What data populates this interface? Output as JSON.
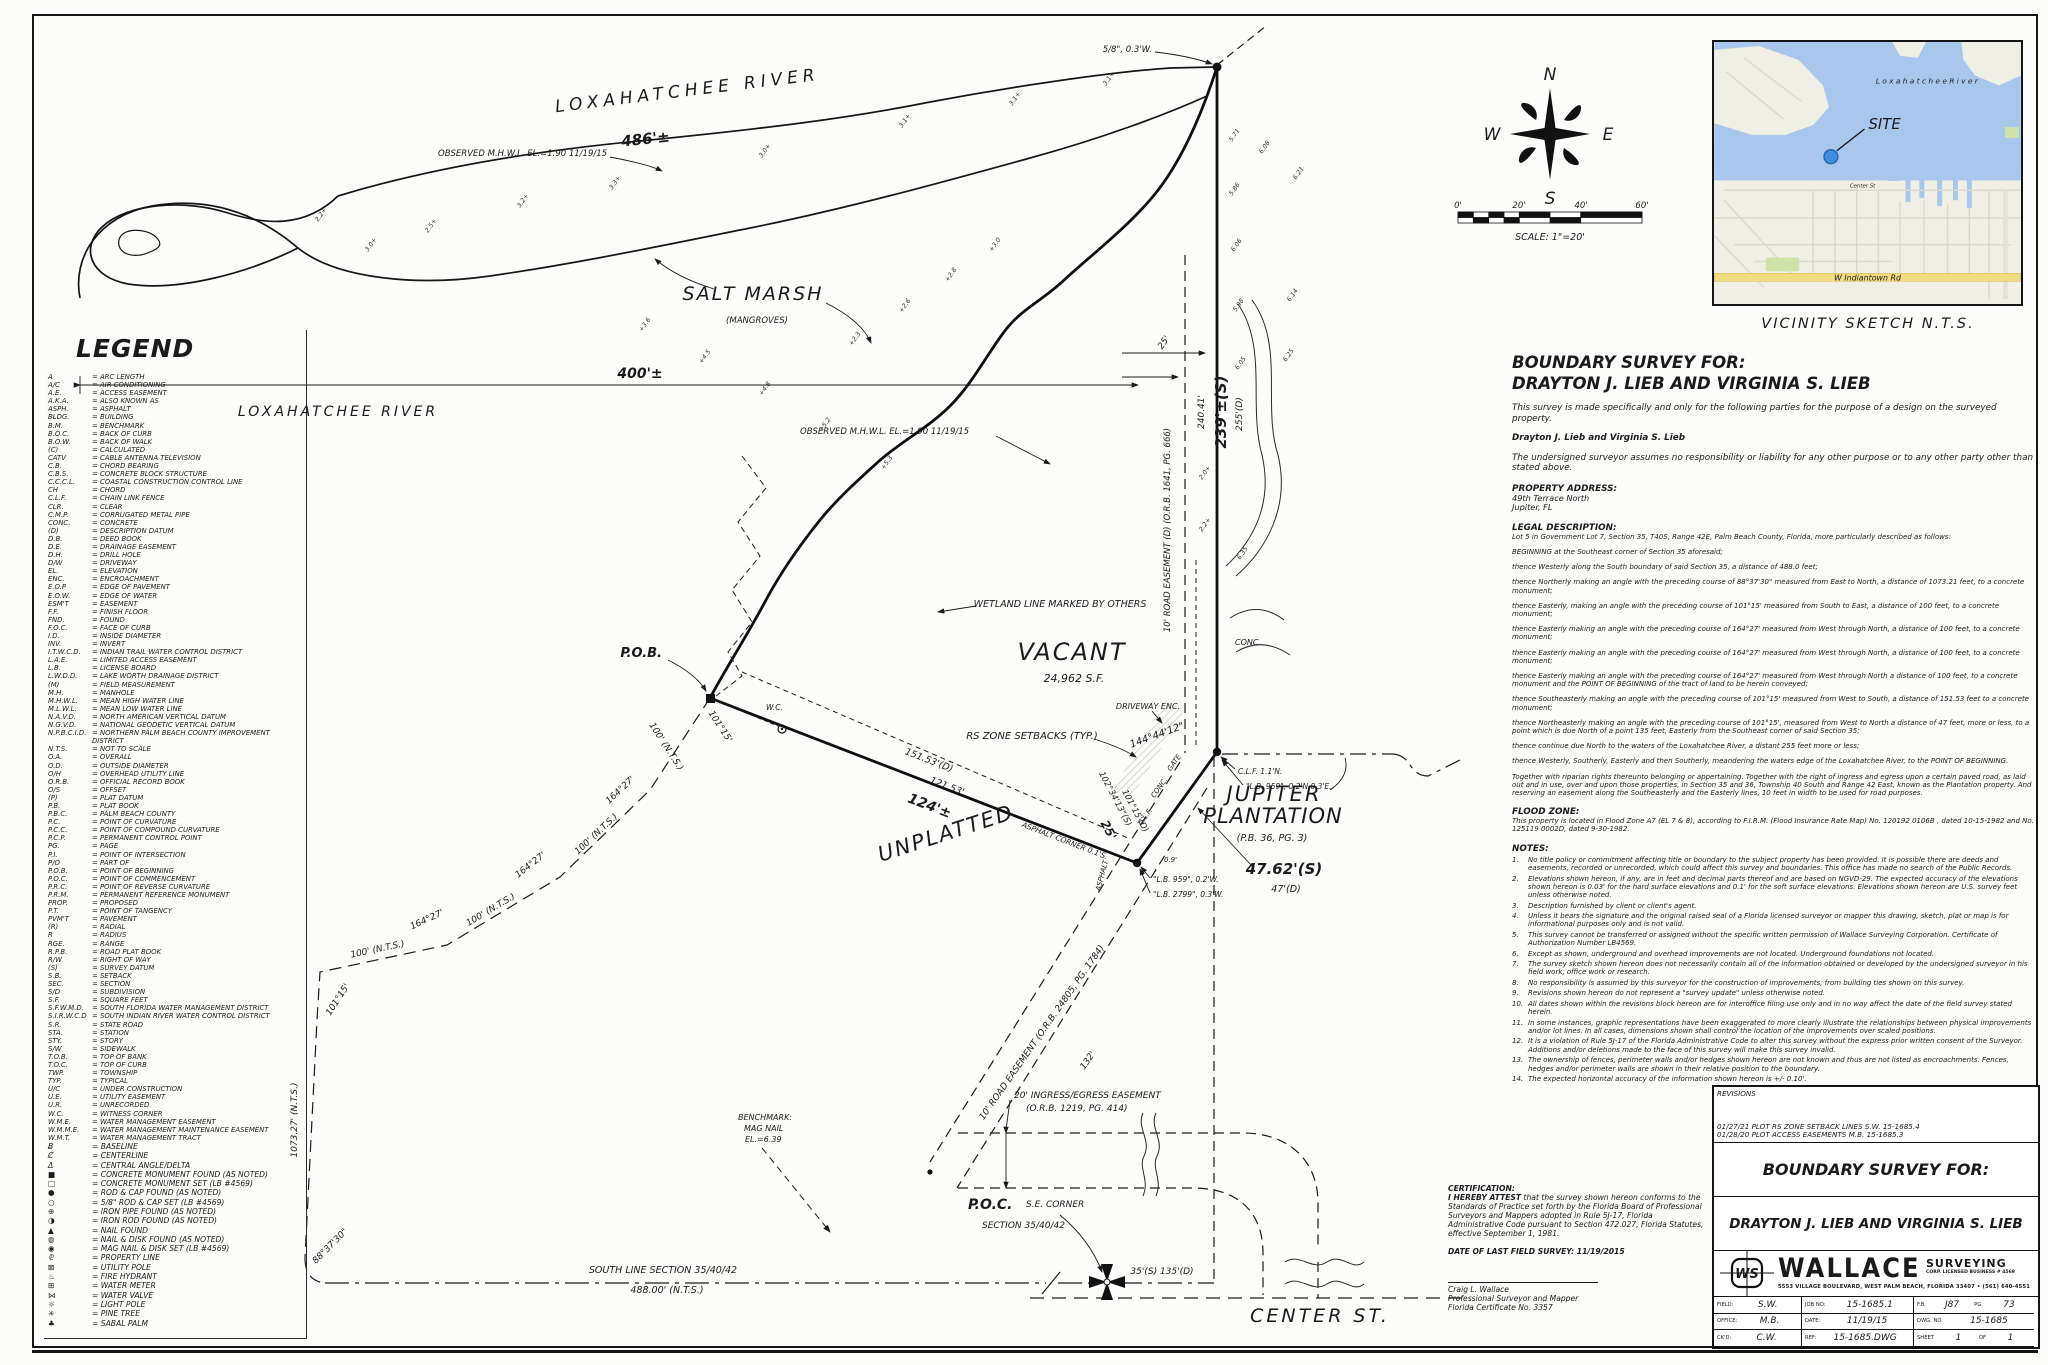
{
  "legend": {
    "title": "LEGEND",
    "entries": [
      {
        "a": "A",
        "m": "ARC LENGTH"
      },
      {
        "a": "A/C",
        "m": "AIR CONDITIONING"
      },
      {
        "a": "A.E.",
        "m": "ACCESS EASEMENT"
      },
      {
        "a": "A.K.A.",
        "m": "ALSO KNOWN AS"
      },
      {
        "a": "ASPH.",
        "m": "ASPHALT"
      },
      {
        "a": "BLDG.",
        "m": "BUILDING"
      },
      {
        "a": "B.M.",
        "m": "BENCHMARK"
      },
      {
        "a": "B.O.C.",
        "m": "BACK OF CURB"
      },
      {
        "a": "B.O.W.",
        "m": "BACK OF WALK"
      },
      {
        "a": "(C)",
        "m": "CALCULATED"
      },
      {
        "a": "CATV",
        "m": "CABLE ANTENNA TELEVISION"
      },
      {
        "a": "C.B.",
        "m": "CHORD BEARING"
      },
      {
        "a": "C.B.S.",
        "m": "CONCRETE BLOCK STRUCTURE"
      },
      {
        "a": "C.C.C.L.",
        "m": "COASTAL CONSTRUCTION CONTROL LINE"
      },
      {
        "a": "CH",
        "m": "CHORD"
      },
      {
        "a": "C.L.F.",
        "m": "CHAIN LINK FENCE"
      },
      {
        "a": "CLR.",
        "m": "CLEAR"
      },
      {
        "a": "C.M.P.",
        "m": "CORRUGATED METAL PIPE"
      },
      {
        "a": "CONC.",
        "m": "CONCRETE"
      },
      {
        "a": "(D)",
        "m": "DESCRIPTION DATUM"
      },
      {
        "a": "D.B.",
        "m": "DEED BOOK"
      },
      {
        "a": "D.E.",
        "m": "DRAINAGE EASEMENT"
      },
      {
        "a": "D.H.",
        "m": "DRILL HOLE"
      },
      {
        "a": "D/W",
        "m": "DRIVEWAY"
      },
      {
        "a": "EL.",
        "m": "ELEVATION"
      },
      {
        "a": "ENC.",
        "m": "ENCROACHMENT"
      },
      {
        "a": "E.O.P",
        "m": "EDGE OF PAVEMENT"
      },
      {
        "a": "E.O.W.",
        "m": "EDGE OF WATER"
      },
      {
        "a": "ESM'T",
        "m": "EASEMENT"
      },
      {
        "a": "F.F.",
        "m": "FINISH FLOOR"
      },
      {
        "a": "FND.",
        "m": "FOUND"
      },
      {
        "a": "F.O.C.",
        "m": "FACE OF CURB"
      },
      {
        "a": "I.D.",
        "m": "INSIDE DIAMETER"
      },
      {
        "a": "INV.",
        "m": "INVERT"
      },
      {
        "a": "I.T.W.C.D.",
        "m": "INDIAN TRAIL WATER CONTROL DISTRICT"
      },
      {
        "a": "L.A.E.",
        "m": "LIMITED ACCESS EASEMENT"
      },
      {
        "a": "L.B.",
        "m": "LICENSE BOARD"
      },
      {
        "a": "L.W.D.D.",
        "m": "LAKE WORTH DRAINAGE DISTRICT"
      },
      {
        "a": "(M)",
        "m": "FIELD MEASUREMENT"
      },
      {
        "a": "M.H.",
        "m": "MANHOLE"
      },
      {
        "a": "M.H.W.L.",
        "m": "MEAN HIGH WATER LINE"
      },
      {
        "a": "M.L.W.L.",
        "m": "MEAN LOW WATER LINE"
      },
      {
        "a": "N.A.V.D.",
        "m": "NORTH AMERICAN VERTICAL DATUM"
      },
      {
        "a": "N.G.V.D.",
        "m": "NATIONAL GEODETIC VERTICAL DATUM"
      },
      {
        "a": "N.P.B.C.I.D.",
        "m": "NORTHERN PALM BEACH COUNTY IMPROVEMENT DISTRICT"
      },
      {
        "a": "N.T.S.",
        "m": "NOT TO SCALE"
      },
      {
        "a": "O.A.",
        "m": "OVERALL"
      },
      {
        "a": "O.D.",
        "m": "OUTSIDE DIAMETER"
      },
      {
        "a": "O/H",
        "m": "OVERHEAD UTILITY LINE"
      },
      {
        "a": "O.R.B.",
        "m": "OFFICIAL RECORD BOOK"
      },
      {
        "a": "O/S",
        "m": "OFFSET"
      },
      {
        "a": "(P)",
        "m": "PLAT DATUM"
      },
      {
        "a": "P.B.",
        "m": "PLAT BOOK"
      },
      {
        "a": "P.B.C.",
        "m": "PALM BEACH COUNTY"
      },
      {
        "a": "P.C.",
        "m": "POINT OF CURVATURE"
      },
      {
        "a": "P.C.C.",
        "m": "POINT OF COMPOUND CURVATURE"
      },
      {
        "a": "P.C.P.",
        "m": "PERMANENT CONTROL POINT"
      },
      {
        "a": "PG.",
        "m": "PAGE"
      },
      {
        "a": "P.I.",
        "m": "POINT OF INTERSECTION"
      },
      {
        "a": "P/O",
        "m": "PART OF"
      },
      {
        "a": "P.O.B.",
        "m": "POINT OF BEGINNING"
      },
      {
        "a": "P.O.C.",
        "m": "POINT OF COMMENCEMENT"
      },
      {
        "a": "P.R.C.",
        "m": "POINT OF REVERSE CURVATURE"
      },
      {
        "a": "P.R.M.",
        "m": "PERMANENT REFERENCE MONUMENT"
      },
      {
        "a": "PROP.",
        "m": "PROPOSED"
      },
      {
        "a": "P.T.",
        "m": "POINT OF TANGENCY"
      },
      {
        "a": "PVM'T",
        "m": "PAVEMENT"
      },
      {
        "a": "(R)",
        "m": "RADIAL"
      },
      {
        "a": "R",
        "m": "RADIUS"
      },
      {
        "a": "RGE.",
        "m": "RANGE"
      },
      {
        "a": "R.P.B.",
        "m": "ROAD PLAT BOOK"
      },
      {
        "a": "R/W",
        "m": "RIGHT OF WAY"
      },
      {
        "a": "(S)",
        "m": "SURVEY DATUM"
      },
      {
        "a": "S.B.",
        "m": "SETBACK"
      },
      {
        "a": "SEC.",
        "m": "SECTION"
      },
      {
        "a": "S/D",
        "m": "SUBDIVISION"
      },
      {
        "a": "S.F.",
        "m": "SQUARE FEET"
      },
      {
        "a": "S.F.W.M.D.",
        "m": "SOUTH FLORIDA WATER MANAGEMENT DISTRICT"
      },
      {
        "a": "S.I.R.W.C.D",
        "m": "SOUTH INDIAN RIVER WATER CONTROL DISTRICT"
      },
      {
        "a": "S.R.",
        "m": "STATE ROAD"
      },
      {
        "a": "STA.",
        "m": "STATION"
      },
      {
        "a": "STY.",
        "m": "STORY"
      },
      {
        "a": "S/W",
        "m": "SIDEWALK"
      },
      {
        "a": "T.O.B.",
        "m": "TOP OF BANK"
      },
      {
        "a": "T.O.C.",
        "m": "TOP OF CURB"
      },
      {
        "a": "TWP.",
        "m": "TOWNSHIP"
      },
      {
        "a": "TYP.",
        "m": "TYPICAL"
      },
      {
        "a": "U/C",
        "m": "UNDER CONSTRUCTION"
      },
      {
        "a": "U.E.",
        "m": "UTILITY EASEMENT"
      },
      {
        "a": "U.R.",
        "m": "UNRECORDED"
      },
      {
        "a": "W.C.",
        "m": "WITNESS CORNER"
      },
      {
        "a": "W.M.E.",
        "m": "WATER MANAGEMENT EASEMENT"
      },
      {
        "a": "W.M.M.E.",
        "m": "WATER MANAGEMENT MAINTENANCE EASEMENT"
      },
      {
        "a": "W.M.T.",
        "m": "WATER MANAGEMENT TRACT"
      },
      {
        "a": "Ƀ",
        "m": "BASELINE",
        "sym": true
      },
      {
        "a": "Ȼ",
        "m": "CENTERLINE",
        "sym": true
      },
      {
        "a": "Δ",
        "m": "CENTRAL ANGLE/DELTA",
        "sym": true
      },
      {
        "a": "■",
        "m": "CONCRETE MONUMENT FOUND (AS NOTED)",
        "sym": true
      },
      {
        "a": "□",
        "m": "CONCRETE MONUMENT SET (LB #4569)",
        "sym": true
      },
      {
        "a": "●",
        "m": "ROD & CAP FOUND (AS NOTED)",
        "sym": true
      },
      {
        "a": "○",
        "m": "5/8\" ROD & CAP SET (LB #4569)",
        "sym": true
      },
      {
        "a": "⊕",
        "m": "IRON PIPE FOUND (AS NOTED)",
        "sym": true
      },
      {
        "a": "◑",
        "m": "IRON ROD FOUND (AS NOTED)",
        "sym": true
      },
      {
        "a": "▲",
        "m": "NAIL FOUND",
        "sym": true
      },
      {
        "a": "◍",
        "m": "NAIL & DISK FOUND (AS NOTED)",
        "sym": true
      },
      {
        "a": "◉",
        "m": "MAG NAIL & DISK SET (LB #4569)",
        "sym": true
      },
      {
        "a": "⅊",
        "m": "PROPERTY LINE",
        "sym": true
      },
      {
        "a": "⊠",
        "m": "UTILITY POLE",
        "sym": true
      },
      {
        "a": "♨",
        "m": "FIRE HYDRANT",
        "sym": true
      },
      {
        "a": "⊞",
        "m": "WATER METER",
        "sym": true
      },
      {
        "a": "⋈",
        "m": "WATER VALVE",
        "sym": true
      },
      {
        "a": "☼",
        "m": "LIGHT POLE",
        "sym": true
      },
      {
        "a": "✳",
        "m": "PINE TREE",
        "sym": true
      },
      {
        "a": "♣",
        "m": "SABAL PALM",
        "sym": true
      }
    ]
  },
  "survey_text": {
    "title1": "BOUNDARY SURVEY FOR:",
    "title2": "DRAYTON J. LIEB AND VIRGINIA S. LIEB",
    "intro": "This survey is made specifically and only for the following parties for the purpose of a design on the surveyed property.",
    "parties": "Drayton J. Lieb and Virginia S. Lieb",
    "disclaimer": "The undersigned surveyor assumes no responsibility or liability for any other purpose or to any other party other than stated above.",
    "property_address_label": "PROPERTY ADDRESS:",
    "property_address": [
      "49th Terrace North",
      "Jupiter, FL"
    ],
    "legal_label": "LEGAL DESCRIPTION:",
    "legal_intro": "Lot 5 in Government Lot 7, Section 35, T40S, Range 42E, Palm Beach County, Florida, more particularly described as follows:",
    "legal_body": [
      "BEGINNING at the Southeast corner of Section 35 aforesaid;",
      "thence Westerly along the South boundary of said Section 35, a distance of 488.0 feet;",
      "thence Northerly making an angle with the preceding course of 88°37'30\" measured from East to North, a distance of 1073.21 feet, to a concrete monument;",
      "thence Easterly, making an angle with the preceding course of 101°15' measured from South to East, a distance of 100 feet, to a concrete monument;",
      "thence Easterly making an angle with the preceding course of 164°27' measured from West through North, a distance of 100 feet, to a concrete monument;",
      "thence Easterly making an angle with the preceding course of 164°27' measured from West through North, a distance of 100 feet, to a concrete monument;",
      "thence Easterly making an angle with the preceding course of 164°27' measured from West through North a distance of 100 feet, to a concrete monument and the POINT OF BEGINNING of the tract of land to be herein conveyed;",
      "thence Southeasterly making an angle with the preceding course of 101°15' measured from West to South, a distance of 151.53 feet to a concrete monument;",
      "thence Northeasterly making an angle with the preceding course of 101°15', measured from West to North a distance of 47 feet, more or less, to a point which is due North of a point 135 feet, Easterly from the Southeast corner of said Section 35;",
      "thence continue due North to the waters of the Loxahatchee River, a distant 255 feet more or less;",
      "thence Westerly, Southerly, Easterly and then Southerly, meandering the waters edge of the Loxahatchee River, to the POINT OF BEGINNING.",
      "Together with riparian rights thereunto belonging or appertaining.  Together with the right of ingress and egress upon a certain paved road, as laid out and in use, over and upon those properties, in Section 35 and 36, Township 40 South and Range 42 East, known as the Plantation property.  And reserving an easement along the Southeasterly and the Easterly lines, 10 feet in width to be used for road purposes."
    ],
    "flood_label": "FLOOD ZONE:",
    "flood_text": "This property is located in Flood Zone A7 (EL 7 & 8), according to F.I.R.M. (Flood Insurance Rate Map) No. 120192 0106B , dated 10-15-1982 and No. 125119 0002D, dated 9-30-1982.",
    "notes_label": "NOTES:",
    "notes": [
      "No title policy or commitment affecting title or boundary to the subject property has been provided.  It is possible there are deeds and easements, recorded or unrecorded, which could affect this survey and boundaries.  This office has made no search of the Public Records.",
      "Elevations shown hereon, if any, are in feet and decimal parts thereof and are based on NGVD-29. The expected accuracy of the elevations shown hereon is 0.03' for the hard surface elevations and 0.1' for the soft surface elevations. Elevations shown hereon are U.S. survey feet unless otherwise noted.",
      "Description furnished by client or client's agent.",
      "Unless it bears the signature and the original raised seal of a Florida licensed surveyor or mapper this drawing, sketch, plat or map is for informational purposes only and is not valid.",
      "This survey cannot be transferred or assigned without the specific written permission of Wallace Surveying Corporation. Certificate of Authorization Number LB4569.",
      "Except as shown, underground and overhead improvements are not located. Underground foundations not located.",
      "The survey sketch shown hereon does not necessarily contain all of the information obtained or developed by the undersigned surveyor in his field work, office work or research.",
      "No responsibility is assumed by this surveyor for the construction of improvements, from building ties shown on this survey.",
      "Revisions shown hereon do not represent a \"survey update\" unless otherwise noted.",
      "All dates shown within the revisions block hereon are for interoffice filing use only and in no way affect the date of the field survey stated herein.",
      "In some instances, graphic representations have been exaggerated to more clearly illustrate the relationships between physical improvements and/or lot lines. In all cases, dimensions shown shall control the location of the improvements over scaled positions.",
      "It is a violation of Rule 5J-17 of the Florida Administrative Code to alter this survey without the express prior written consent of the Surveyor. Additions and/or deletions made to the face of this survey will make this survey invalid.",
      "The ownership of fences, perimeter walls and/or hedges shown hereon are not known and thus are not listed as encroachments. Fences, hedges and/or perimeter walls are shown in their relative position to the boundary.",
      "The expected horizontal accuracy of the information shown hereon is +/- 0.10'."
    ]
  },
  "certification": {
    "label": "CERTIFICATION:",
    "attest_bold": "I HEREBY ATTEST",
    "attest_rest": " that the survey shown hereon conforms to the Standards of Practice set forth by the Florida Board of Professional Surveyors and Mappers adopted in Rule 5J-17, Florida Administrative Code pursuant to Section 472.027, Florida Statutes, effective September 1, 1981.",
    "date_line": "DATE OF LAST FIELD SURVEY:  11/19/2015",
    "signer": "Craig L. Wallace",
    "signer_title": "Professional Surveyor and Mapper",
    "signer_cert": "Florida Certificate No. 3357"
  },
  "title_block": {
    "revisions_label": "REVISIONS",
    "revisions": [
      "01/27/21  PLOT RS ZONE SETBACK LINES  S.W.  15-1685.4",
      "01/28/20  PLOT ACCESS EASEMENTS  M.B.  15-1685.3"
    ],
    "survey_for": "BOUNDARY SURVEY FOR:",
    "client": "DRAYTON J. LIEB AND VIRGINIA S. LIEB",
    "logo_monogram": "WS",
    "logo_name": "WALLACE",
    "logo_name2": "SURVEYING",
    "logo_corp": "CORP. LICENSED BUSINESS # 4569",
    "logo_addr": "5553 VILLAGE BOULEVARD, WEST PALM BEACH, FLORIDA 33407 • (561) 640-4551",
    "fields": {
      "field_label": "FIELD:",
      "field_value": "S.W.",
      "job_label": "JOB NO:",
      "job_value": "15-1685.1",
      "fb_label": "F.B.",
      "fb_value": "J87",
      "pg_label": "PG.",
      "pg_value": "73",
      "office_label": "OFFICE:",
      "office_value": "M.B.",
      "date_label": "DATE:",
      "date_value": "11/19/15",
      "dwg_label": "DWG. NO.",
      "dwg_value": "15-1685",
      "ckd_label": "CK'D:",
      "ckd_value": "C.W.",
      "ref_label": "REF:",
      "ref_value": "15-1685.DWG",
      "sheet_label": "SHEET",
      "sheet_value": "1",
      "of_label": "OF",
      "of_value": "1"
    }
  },
  "compass": {
    "n": "N",
    "s": "S",
    "e": "E",
    "w": "W"
  },
  "scale_bar": {
    "ticks": [
      "0'",
      "20'",
      "40'",
      "60'"
    ],
    "caption": "SCALE:  1\"=20'"
  },
  "vicinity": {
    "caption": "VICINITY SKETCH  N.T.S.",
    "site_label": "SITE",
    "river_label": "L o x a h a t c h e e   R i v e r",
    "road_label": "W Indiantown Rd",
    "street_label": "Center St",
    "colors": {
      "water": "#a9c7ec",
      "land": "#f0efe6",
      "road_yellow": "#f2dc82",
      "park": "#cfe3a8",
      "site": "#3f8fe0"
    }
  },
  "drawing": {
    "labels": {
      "river_name": "LOXAHATCHEE RIVER",
      "dim486": "486'±",
      "mhwl": "OBSERVED M.H.W.L.  EL.=1.90  11/19/15",
      "salt_marsh": "SALT  MARSH",
      "mangroves": "(MANGROVES)",
      "dim400": "400'±",
      "cor_ne": "5/8\", 0.3'W.",
      "dim25": "25'",
      "dim240": "240.41'",
      "dim239": "239'±(S)",
      "dim255": "255'(D)",
      "road_esmt_e": "10' ROAD EASEMENT (D) (O.R.B. 1641, PG. 666)",
      "conc": "CONC.",
      "wetland": "WETLAND LINE MARKED BY OTHERS",
      "vacant": "VACANT",
      "vacant_sf": "24,962 S.F.",
      "driveway": "DRIVEWAY ENC.",
      "ang144": "144°44'12\"",
      "rs_setbacks": "RS ZONE SETBACKS (TYP.)",
      "dim15153": "151.53'(D)",
      "dim12153": "121.53'",
      "dim124": "124'±",
      "ang102": "102°34'13\"(S)",
      "ang101d": "101°15'(D)",
      "dim25b": "25'",
      "asphalt_cor": "ASPHALT CORNER 0.1'S.",
      "gate": "GATE",
      "conc2": "CONC.",
      "clf": "C.L.F.",
      "asphalt_v": "ASPHALT",
      "dim09": "0.9'",
      "lb959w": "\"L.B. 959\", 0.2'W.",
      "lb2799": "\"L.B. 2799\", 0.3'W.",
      "clf_n": "C.L.F.  1.1'N.",
      "lb959ne": "\"L.B. 959\", 0.2'N,0.3'E.",
      "jupiter1": "JUPITER",
      "jupiter2": "PLANTATION",
      "jupiter3": "(P.B. 36, PG. 3)",
      "dim4762": "47.62'(S)",
      "dim47": "47'(D)",
      "unplatted": "UNPLATTED",
      "pob": "P.O.B.",
      "wc": "W.C.",
      "ang10115": "101°15'",
      "dim100": "100' (N.T.S.)",
      "ang16427": "164°27'",
      "dim107327": "1073.27' (N.T.S.)",
      "ang8837": "88°37'30\"",
      "south_line": "SOUTH LINE SECTION 35/40/42",
      "dim488": "488.00' (N.T.S.)",
      "benchmark1": "BENCHMARK:",
      "benchmark2": "MAG NAIL",
      "benchmark3": "EL.=6.39",
      "ingress1": "20' INGRESS/EGRESS EASEMENT",
      "ingress2": "(O.R.B. 1219, PG. 414)",
      "poc": "P.O.C.",
      "poc2": "S.E. CORNER",
      "poc3": "SECTION 35/40/42",
      "dim35135": "35'(S)  135'(D)",
      "center_st": "CENTER  ST.",
      "road_esmt_s": "10' ROAD EASEMENT (O.R.B. 24805, PG. 1784)",
      "dim132": "132'"
    },
    "spot_elevations": [
      "2.2+",
      "2.5+",
      "3.0+",
      "3.2+",
      "3.3+",
      "3.0+",
      "3.1+",
      "3.1+",
      "3.1+",
      "+2.3",
      "+2.6",
      "+2.8",
      "+3.0",
      "+3.6",
      "+4.5",
      "+4.8",
      "+5.2",
      "+5.3",
      "5.71",
      "5.86",
      "6.06",
      "5.98",
      "6.05",
      "6.08",
      "6.21",
      "6.14",
      "6.25",
      "6.35",
      "2.0+",
      "2.2+"
    ]
  }
}
